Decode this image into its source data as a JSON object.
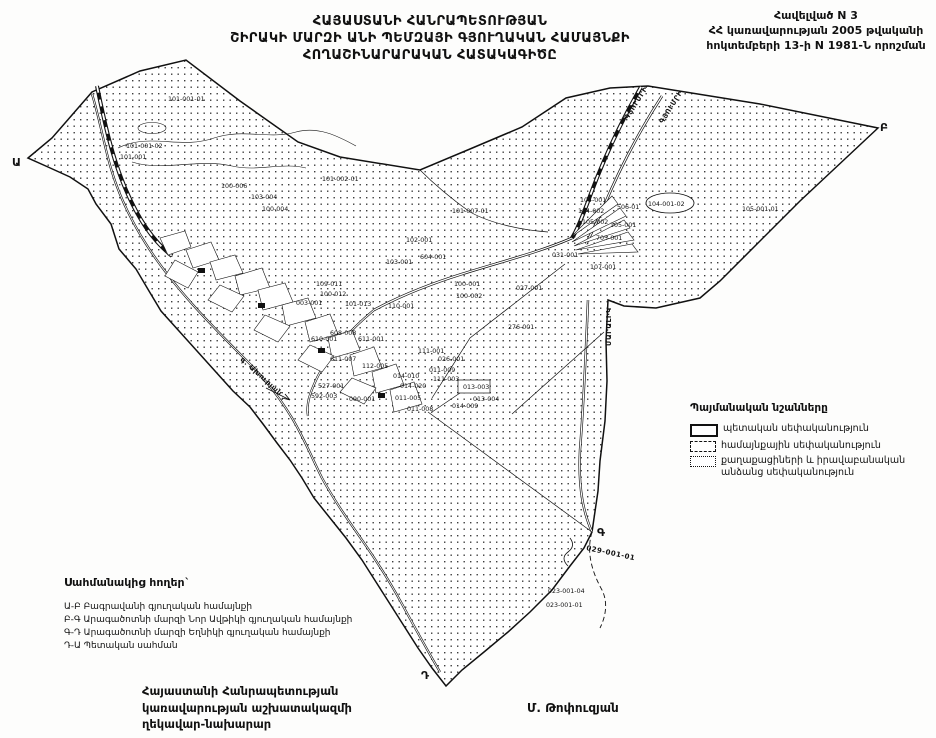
{
  "header": {
    "title_line1": "ՀԱՅԱՍՏԱՆԻ ՀԱՆՐԱՊԵՏՈՒԹՅԱՆ",
    "title_line2": "ՇԻՐԱԿԻ ՄԱՐԶԻ ԱՆԻ ՊԵՄԶԱՅԻ  ԳՅՈՒՂԱԿԱՆ ՀԱՄԱՅՆՔԻ",
    "title_line3": "ՀՈՂԱՇԻՆԱՐԱՐԱԿԱՆ ՀԱՏԱԿԱԳԻԾԸ",
    "annex_line1": "Հավելված N 3",
    "annex_line2": "ՀՀ կառավարության 2005 թվականի",
    "annex_line3": "հոկտեմբերի 13-ի N 1981-Ն որոշման"
  },
  "legend": {
    "title": "Պայմանական նշանները",
    "items": [
      {
        "label": "պետական սեփականություն",
        "swatch": "solid"
      },
      {
        "label": "համայնքային սեփականություն",
        "swatch": "dashed"
      },
      {
        "label": "քաղաքացիների և իրավաբանական",
        "label2": "անձանց սեփականություն",
        "swatch": "dashdot"
      }
    ]
  },
  "adjacent_lands": {
    "title": "Սահմանակից հողեր`",
    "lines": [
      "Ա-Բ Բագրավանի գյուղական  համայնքի",
      "Բ-Գ Արագածոտնի մարզի Նոր Ավթիկի գյուղական համայնքի",
      "Գ-Դ Արագածոտնի մարզի Եղնիկի  գյուղական համայնքի",
      "Դ-Ա Պետական սահման"
    ]
  },
  "signature": {
    "line1": "Հայաստանի Հանրապետության",
    "line2": "կառավարության աշխատակազմի",
    "line3": "ղեկավար-նախարար",
    "name": "Մ. Թոփուզյան"
  },
  "map": {
    "colors": {
      "ink": "#111111",
      "paper": "#ffffff"
    },
    "point_letters": [
      {
        "t": "Ա",
        "x": 12,
        "y": 166
      },
      {
        "t": "Բ",
        "x": 880,
        "y": 131
      },
      {
        "t": "Գ",
        "x": 597,
        "y": 536
      },
      {
        "t": "Դ",
        "x": 421,
        "y": 679
      }
    ],
    "route_labels": [
      {
        "t": "ԳՅՈՒՄՐԻ",
        "x": 628,
        "y": 120,
        "rot": -58
      },
      {
        "t": "ԳՅՈՒՄՐԻ",
        "x": 663,
        "y": 124,
        "rot": -58
      },
      {
        "t": "ՄԱՐԱԼԻԿ",
        "x": 611,
        "y": 346,
        "rot": -90
      },
      {
        "t": "գ. Ախուրյան",
        "x": 240,
        "y": 360,
        "rot": 42
      },
      {
        "t": "029-001-01",
        "x": 586,
        "y": 550,
        "rot": 12
      }
    ],
    "parcel_labels": [
      {
        "t": "101-001-01",
        "x": 168,
        "y": 101
      },
      {
        "t": "101-001-02",
        "x": 126,
        "y": 148
      },
      {
        "t": "101-001",
        "x": 120,
        "y": 159
      },
      {
        "t": "101-002-01",
        "x": 322,
        "y": 181
      },
      {
        "t": "100-006",
        "x": 221,
        "y": 188
      },
      {
        "t": "103-004",
        "x": 251,
        "y": 199
      },
      {
        "t": "100-004",
        "x": 262,
        "y": 211
      },
      {
        "t": "101-007-01",
        "x": 452,
        "y": 213
      },
      {
        "t": "105-001-01",
        "x": 742,
        "y": 211
      },
      {
        "t": "104-001",
        "x": 580,
        "y": 202
      },
      {
        "t": "104-002",
        "x": 578,
        "y": 213
      },
      {
        "t": "105-002",
        "x": 582,
        "y": 224
      },
      {
        "t": "506-01",
        "x": 617,
        "y": 209
      },
      {
        "t": "104-001-02",
        "x": 648,
        "y": 206
      },
      {
        "t": "105-001",
        "x": 610,
        "y": 227
      },
      {
        "t": "705-001",
        "x": 596,
        "y": 240
      },
      {
        "t": "031-001",
        "x": 552,
        "y": 257
      },
      {
        "t": "107-001",
        "x": 590,
        "y": 269
      },
      {
        "t": "102-001",
        "x": 406,
        "y": 242
      },
      {
        "t": "103-001",
        "x": 386,
        "y": 264
      },
      {
        "t": "604-001",
        "x": 420,
        "y": 259
      },
      {
        "t": "100-001",
        "x": 454,
        "y": 286
      },
      {
        "t": "100-002",
        "x": 456,
        "y": 298
      },
      {
        "t": "027-001",
        "x": 516,
        "y": 290
      },
      {
        "t": "276-001",
        "x": 508,
        "y": 329
      },
      {
        "t": "109-011",
        "x": 316,
        "y": 286
      },
      {
        "t": "100-012",
        "x": 320,
        "y": 296
      },
      {
        "t": "003-001",
        "x": 296,
        "y": 305
      },
      {
        "t": "101-013",
        "x": 345,
        "y": 306
      },
      {
        "t": "110-001",
        "x": 388,
        "y": 308
      },
      {
        "t": "611-001",
        "x": 358,
        "y": 341
      },
      {
        "t": "608-008",
        "x": 330,
        "y": 335
      },
      {
        "t": "610-001",
        "x": 311,
        "y": 341
      },
      {
        "t": "611-007",
        "x": 330,
        "y": 361
      },
      {
        "t": "112-005",
        "x": 362,
        "y": 368
      },
      {
        "t": "111-001",
        "x": 418,
        "y": 353
      },
      {
        "t": "026-001",
        "x": 438,
        "y": 361
      },
      {
        "t": "111-003",
        "x": 433,
        "y": 381
      },
      {
        "t": "014-010",
        "x": 393,
        "y": 378
      },
      {
        "t": "014-020",
        "x": 400,
        "y": 388
      },
      {
        "t": "011-005",
        "x": 395,
        "y": 400
      },
      {
        "t": "527-001",
        "x": 318,
        "y": 388
      },
      {
        "t": "592-003",
        "x": 311,
        "y": 398
      },
      {
        "t": "090-001",
        "x": 349,
        "y": 401
      },
      {
        "t": "014-009",
        "x": 452,
        "y": 408
      },
      {
        "t": "011-009",
        "x": 429,
        "y": 372
      },
      {
        "t": "013-003",
        "x": 463,
        "y": 389
      },
      {
        "t": "013-004",
        "x": 473,
        "y": 401
      },
      {
        "t": "011-008",
        "x": 407,
        "y": 411
      },
      {
        "t": "023-001-04",
        "x": 548,
        "y": 593
      },
      {
        "t": "023-001-01",
        "x": 546,
        "y": 607
      }
    ]
  }
}
